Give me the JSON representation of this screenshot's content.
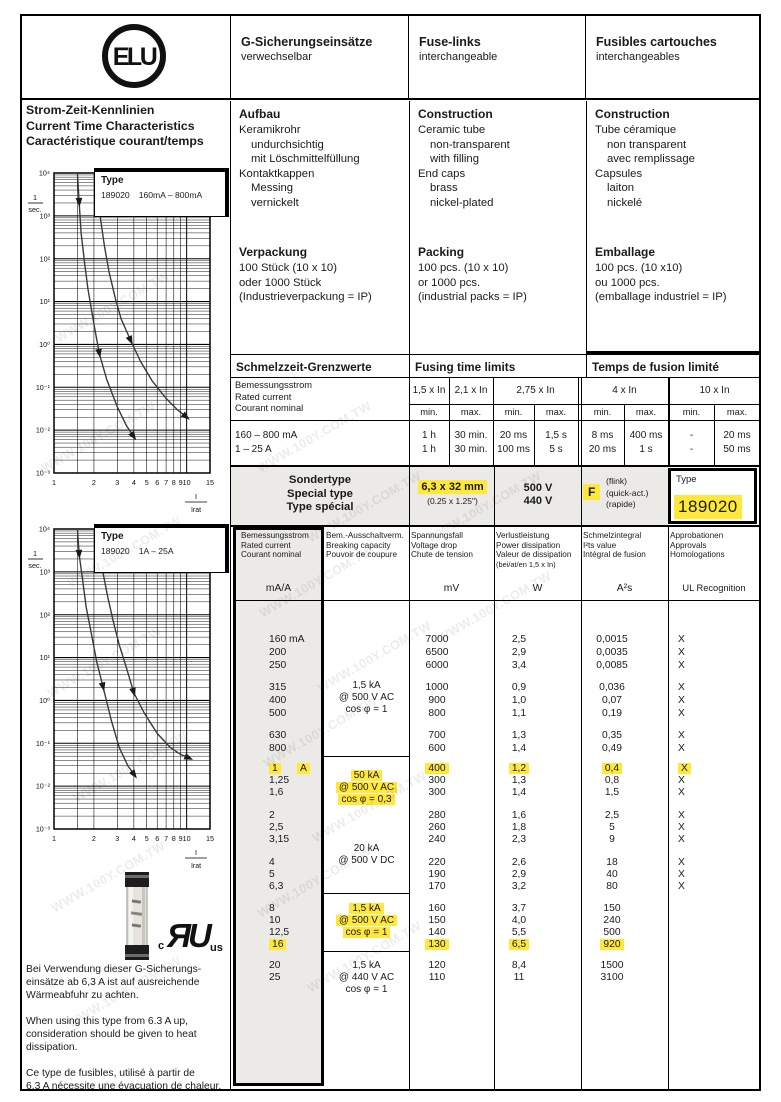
{
  "page": {
    "watermark": "WWW.100Y.COM.TW"
  },
  "header": {
    "logo": "ELU",
    "columns": [
      {
        "title": "G-Sicherungseinsätze",
        "subtitle": "verwechselbar"
      },
      {
        "title": "Fuse-links",
        "subtitle": "interchangeable"
      },
      {
        "title": "Fusibles cartouches",
        "subtitle": "interchangeables"
      }
    ]
  },
  "left": {
    "title_lines": [
      "Strom-Zeit-Kennlinien",
      "Current Time Characteristics",
      "Caractéristique courant/temps"
    ],
    "notes": [
      {
        "lines": [
          "Bei Verwendung dieser G-Sicherungs-",
          "einsätze ab 6,3 A ist auf ausreichende",
          "Wärmeabfuhr zu achten."
        ]
      },
      {
        "lines": [
          "When using this type from 6.3 A up,",
          "consideration should be given to heat",
          "dissipation."
        ]
      },
      {
        "lines": [
          "Ce type de fusibles, utilisé à partir de",
          "6,3 A nécessite une évacuation de chaleur."
        ]
      }
    ],
    "ul_mark": {
      "left": "c",
      "letters": "ЯU",
      "right": "us"
    }
  },
  "info_columns": [
    {
      "construction": {
        "heading": "Aufbau",
        "lines": [
          {
            "t": "Keramikrohr",
            "i": 0
          },
          {
            "t": "undurchsichtig",
            "i": 1
          },
          {
            "t": "mit Löschmittelfüllung",
            "i": 1
          },
          {
            "t": "Kontaktkappen",
            "i": 0
          },
          {
            "t": "Messing",
            "i": 1
          },
          {
            "t": "vernickelt",
            "i": 1
          }
        ]
      },
      "packing": {
        "heading": "Verpackung",
        "lines": [
          {
            "t": "100 Stück (10 x 10)",
            "i": 0
          },
          {
            "t": "oder 1000 Stück",
            "i": 0
          },
          {
            "t": "(Industrieverpackung = IP)",
            "i": 0
          }
        ]
      }
    },
    {
      "construction": {
        "heading": "Construction",
        "lines": [
          {
            "t": "Ceramic tube",
            "i": 0
          },
          {
            "t": "non-transparent",
            "i": 1
          },
          {
            "t": "with filling",
            "i": 1
          },
          {
            "t": "End caps",
            "i": 0
          },
          {
            "t": "brass",
            "i": 1
          },
          {
            "t": "nickel-plated",
            "i": 1
          }
        ]
      },
      "packing": {
        "heading": "Packing",
        "lines": [
          {
            "t": "100 pcs. (10 x 10)",
            "i": 0
          },
          {
            "t": "or 1000 pcs.",
            "i": 0
          },
          {
            "t": "(industrial packs = IP)",
            "i": 0
          }
        ]
      }
    },
    {
      "construction": {
        "heading": "Construction",
        "lines": [
          {
            "t": "Tube céramique",
            "i": 0
          },
          {
            "t": "non transparent",
            "i": 1
          },
          {
            "t": "avec remplissage",
            "i": 1
          },
          {
            "t": "Capsules",
            "i": 0
          },
          {
            "t": "laiton",
            "i": 1
          },
          {
            "t": "nickelé",
            "i": 1
          }
        ]
      },
      "packing": {
        "heading": "Emballage",
        "lines": [
          {
            "t": "100 pcs. (10 x10)",
            "i": 0
          },
          {
            "t": "ou 1000 pcs.",
            "i": 0
          },
          {
            "t": "(emballage industriel = IP)",
            "i": 0
          }
        ]
      }
    }
  ],
  "fusing": {
    "titles": [
      "Schmelzzeit-Grenzwerte",
      "Fusing time limits",
      "Temps de fusion limité"
    ],
    "row_label_lines": [
      "Bemessungsstrom",
      "Rated current",
      "Courant nominal"
    ],
    "groups": [
      {
        "label": "1,5 x In",
        "cols": [
          "min."
        ]
      },
      {
        "label": "2,1 x In",
        "cols": [
          "max."
        ]
      },
      {
        "label": "2,75 x In",
        "cols": [
          "min.",
          "max."
        ]
      },
      {
        "label": "4 x In",
        "cols": [
          "min.",
          "max."
        ]
      },
      {
        "label": "10 x In",
        "cols": [
          "min.",
          "max."
        ]
      }
    ],
    "rows": [
      {
        "label": "160 – 800 mA",
        "values": [
          "1 h",
          "30 min.",
          "20 ms",
          "1,5 s",
          "8 ms",
          "400 ms",
          "-",
          "20 ms"
        ]
      },
      {
        "label": "1 – 25 A",
        "values": [
          "1 h",
          "30 min.",
          "100 ms",
          "5 s",
          "20 ms",
          "1 s",
          "-",
          "50 ms"
        ]
      }
    ]
  },
  "special": {
    "label_lines": [
      "Sondertype",
      "Special type",
      "Type spécial"
    ],
    "size": "6,3 x 32 mm",
    "size_inch": "(0.25 x 1.25\")",
    "voltages": [
      "500 V",
      "440 V"
    ],
    "code": "F",
    "code_desc": [
      "(flink)",
      "(quick-act.)",
      "(rapide)"
    ],
    "type_label": "Type",
    "type_value": "189020"
  },
  "main_table": {
    "headers": [
      {
        "lines": [
          "Bemessungsstrom",
          "Rated current",
          "Courant nominal"
        ],
        "unit": "mA/A"
      },
      {
        "lines": [
          "Bem.-Ausschaltverm.",
          "Breaking capacity",
          "Pouvoir de coupure"
        ],
        "unit": ""
      },
      {
        "lines": [
          "Spannungsfall",
          "Voltage drop",
          "Chute de tension"
        ],
        "unit": "mV"
      },
      {
        "lines": [
          "Verlustleistung",
          "Power dissipation",
          "Valeur de dissipation",
          "(bei/at/en 1,5 x In)"
        ],
        "unit": "W"
      },
      {
        "lines": [
          "Schmelzintegral",
          "I²ts value",
          "Intégral de fusion"
        ],
        "unit": "A²s"
      },
      {
        "lines": [
          "Approbationen",
          "Approvals",
          "Homologations"
        ],
        "unit": "UL Recognition"
      }
    ],
    "groups": [
      {
        "breaking": [
          {
            "t": "1,5 kA"
          },
          {
            "t": "@ 500 V AC"
          },
          {
            "t": "cos φ = 1"
          }
        ],
        "clusters": [
          [
            {
              "cur": "160 mA",
              "mv": "7000",
              "w": "2,5",
              "i2t": "0,0015",
              "ul": "X"
            },
            {
              "cur": "200",
              "mv": "6500",
              "w": "2,9",
              "i2t": "0,0035",
              "ul": "X"
            },
            {
              "cur": "250",
              "mv": "6000",
              "w": "3,4",
              "i2t": "0,0085",
              "ul": "X"
            }
          ],
          [
            {
              "cur": "315",
              "mv": "1000",
              "w": "0,9",
              "i2t": "0,036",
              "ul": "X"
            },
            {
              "cur": "400",
              "mv": "900",
              "w": "1,0",
              "i2t": "0,07",
              "ul": "X"
            },
            {
              "cur": "500",
              "mv": "800",
              "w": "1,1",
              "i2t": "0,19",
              "ul": "X"
            }
          ],
          [
            {
              "cur": "630",
              "mv": "700",
              "w": "1,3",
              "i2t": "0,35",
              "ul": "X"
            },
            {
              "cur": "800",
              "mv": "600",
              "w": "1,4",
              "i2t": "0,49",
              "ul": "X"
            }
          ]
        ]
      },
      {
        "breaking": [
          {
            "t": "50 kA",
            "hl": true
          },
          {
            "t": "@ 500 V AC",
            "hl": true
          },
          {
            "t": "cos φ = 0,3",
            "hl": true
          },
          {
            "t": ""
          },
          {
            "t": "20 kA"
          },
          {
            "t": "@ 500 V DC"
          }
        ],
        "clusters": [
          [
            {
              "cur": "1",
              "cur2": "A",
              "mv": "400",
              "w": "1,2",
              "i2t": "0,4",
              "ul": "X",
              "hl": [
                "cur",
                "cur2",
                "mv",
                "w",
                "i2t",
                "ul"
              ]
            },
            {
              "cur": "1,25",
              "mv": "300",
              "w": "1,3",
              "i2t": "0,8",
              "ul": "X"
            },
            {
              "cur": "1,6",
              "mv": "300",
              "w": "1,4",
              "i2t": "1,5",
              "ul": "X"
            }
          ],
          [
            {
              "cur": "2",
              "mv": "280",
              "w": "1,6",
              "i2t": "2,5",
              "ul": "X"
            },
            {
              "cur": "2,5",
              "mv": "260",
              "w": "1,8",
              "i2t": "5",
              "ul": "X"
            },
            {
              "cur": "3,15",
              "mv": "240",
              "w": "2,3",
              "i2t": "9",
              "ul": "X"
            }
          ],
          [
            {
              "cur": "4",
              "mv": "220",
              "w": "2,6",
              "i2t": "18",
              "ul": "X"
            },
            {
              "cur": "5",
              "mv": "190",
              "w": "2,9",
              "i2t": "40",
              "ul": "X"
            },
            {
              "cur": "6,3",
              "mv": "170",
              "w": "3,2",
              "i2t": "80",
              "ul": "X"
            }
          ]
        ]
      },
      {
        "breaking": [
          {
            "t": "1,5 kA",
            "hl": true
          },
          {
            "t": "@ 500 V AC",
            "hl": true
          },
          {
            "t": "cos φ = 1",
            "hl": true
          }
        ],
        "clusters": [
          [
            {
              "cur": "8",
              "mv": "160",
              "w": "3,7",
              "i2t": "150",
              "ul": ""
            },
            {
              "cur": "10",
              "mv": "150",
              "w": "4,0",
              "i2t": "240",
              "ul": ""
            },
            {
              "cur": "12,5",
              "mv": "140",
              "w": "5,5",
              "i2t": "500",
              "ul": ""
            },
            {
              "cur": "16",
              "mv": "130",
              "w": "6,5",
              "i2t": "920",
              "ul": "",
              "hl": [
                "cur",
                "mv",
                "w",
                "i2t"
              ]
            }
          ]
        ]
      },
      {
        "breaking": [
          {
            "t": "1,5 kA"
          },
          {
            "t": "@ 440 V AC"
          },
          {
            "t": "cos φ = 1"
          }
        ],
        "clusters": [
          [
            {
              "cur": "20",
              "mv": "120",
              "w": "8,4",
              "i2t": "1500",
              "ul": ""
            },
            {
              "cur": "25",
              "mv": "110",
              "w": "11",
              "i2t": "3100",
              "ul": ""
            }
          ]
        ]
      }
    ]
  },
  "chart_data": [
    {
      "type": "line",
      "title": "Current-time characteristic Type 189020 160mA – 800mA",
      "legend": {
        "type_label": "Type",
        "type_value": "189020",
        "range": "160mA – 800mA"
      },
      "xlabel_fraction": {
        "num": "I",
        "den": "Irat"
      },
      "ylabel_fraction": {
        "num": "1",
        "den": "sec."
      },
      "x_scale": "log",
      "y_scale": "log",
      "xlim": [
        1,
        15
      ],
      "ylim": [
        0.001,
        10000
      ],
      "x_ticks": [
        1,
        2,
        3,
        4,
        5,
        6,
        7,
        8,
        9,
        10,
        15
      ],
      "x_minor": [
        1.5
      ],
      "y_ticks": [
        "10⁴",
        "10³",
        "10²",
        "10¹",
        "10⁰",
        "10⁻¹",
        "10⁻²",
        "10⁻³"
      ],
      "series": [
        {
          "name": "lower limit",
          "points": [
            [
              1.5,
              10000
            ],
            [
              1.55,
              2000
            ],
            [
              1.6,
              400
            ],
            [
              1.7,
              80
            ],
            [
              1.8,
              20
            ],
            [
              2.0,
              3
            ],
            [
              2.2,
              0.6
            ],
            [
              2.5,
              0.15
            ],
            [
              3.0,
              0.035
            ],
            [
              3.5,
              0.013
            ],
            [
              4.0,
              0.007
            ]
          ]
        },
        {
          "name": "upper limit",
          "points": [
            [
              2.1,
              10000
            ],
            [
              2.15,
              3000
            ],
            [
              2.25,
              800
            ],
            [
              2.4,
              200
            ],
            [
              2.6,
              50
            ],
            [
              2.9,
              12
            ],
            [
              3.2,
              4
            ],
            [
              3.8,
              1.2
            ],
            [
              4.5,
              0.4
            ],
            [
              5.5,
              0.14
            ],
            [
              7.0,
              0.055
            ],
            [
              8.5,
              0.03
            ],
            [
              10.0,
              0.02
            ]
          ]
        }
      ]
    },
    {
      "type": "line",
      "title": "Current-time characteristic Type 189020 1A – 25A",
      "legend": {
        "type_label": "Type",
        "type_value": "189020",
        "range": "1A – 25A"
      },
      "xlabel_fraction": {
        "num": "I",
        "den": "Irat"
      },
      "ylabel_fraction": {
        "num": "1",
        "den": "sec."
      },
      "x_scale": "log",
      "y_scale": "log",
      "xlim": [
        1,
        15
      ],
      "ylim": [
        0.001,
        10000
      ],
      "x_ticks": [
        1,
        2,
        3,
        4,
        5,
        6,
        7,
        8,
        9,
        10,
        15
      ],
      "x_minor": [
        1.5
      ],
      "y_ticks": [
        "10⁴",
        "10³",
        "10²",
        "10¹",
        "10⁰",
        "10⁻¹",
        "10⁻²",
        "10⁻³"
      ],
      "series": [
        {
          "name": "lower limit",
          "points": [
            [
              1.5,
              10000
            ],
            [
              1.55,
              2500
            ],
            [
              1.65,
              600
            ],
            [
              1.75,
              150
            ],
            [
              1.9,
              40
            ],
            [
              2.1,
              8
            ],
            [
              2.35,
              2
            ],
            [
              2.7,
              0.35
            ],
            [
              3.1,
              0.08
            ],
            [
              3.6,
              0.03
            ],
            [
              4.05,
              0.018
            ]
          ]
        },
        {
          "name": "upper limit",
          "points": [
            [
              2.1,
              10000
            ],
            [
              2.2,
              3000
            ],
            [
              2.35,
              900
            ],
            [
              2.55,
              250
            ],
            [
              2.8,
              70
            ],
            [
              3.1,
              20
            ],
            [
              3.5,
              6
            ],
            [
              4.0,
              1.5
            ],
            [
              4.8,
              0.5
            ],
            [
              6.0,
              0.17
            ],
            [
              7.5,
              0.08
            ],
            [
              9.0,
              0.055
            ],
            [
              10.5,
              0.045
            ]
          ]
        }
      ]
    }
  ],
  "colors": {
    "highlight": "#ffe83a",
    "paper": "#ffffff",
    "ink": "#1a1a1a",
    "gray_bg": "#ebeae7"
  }
}
